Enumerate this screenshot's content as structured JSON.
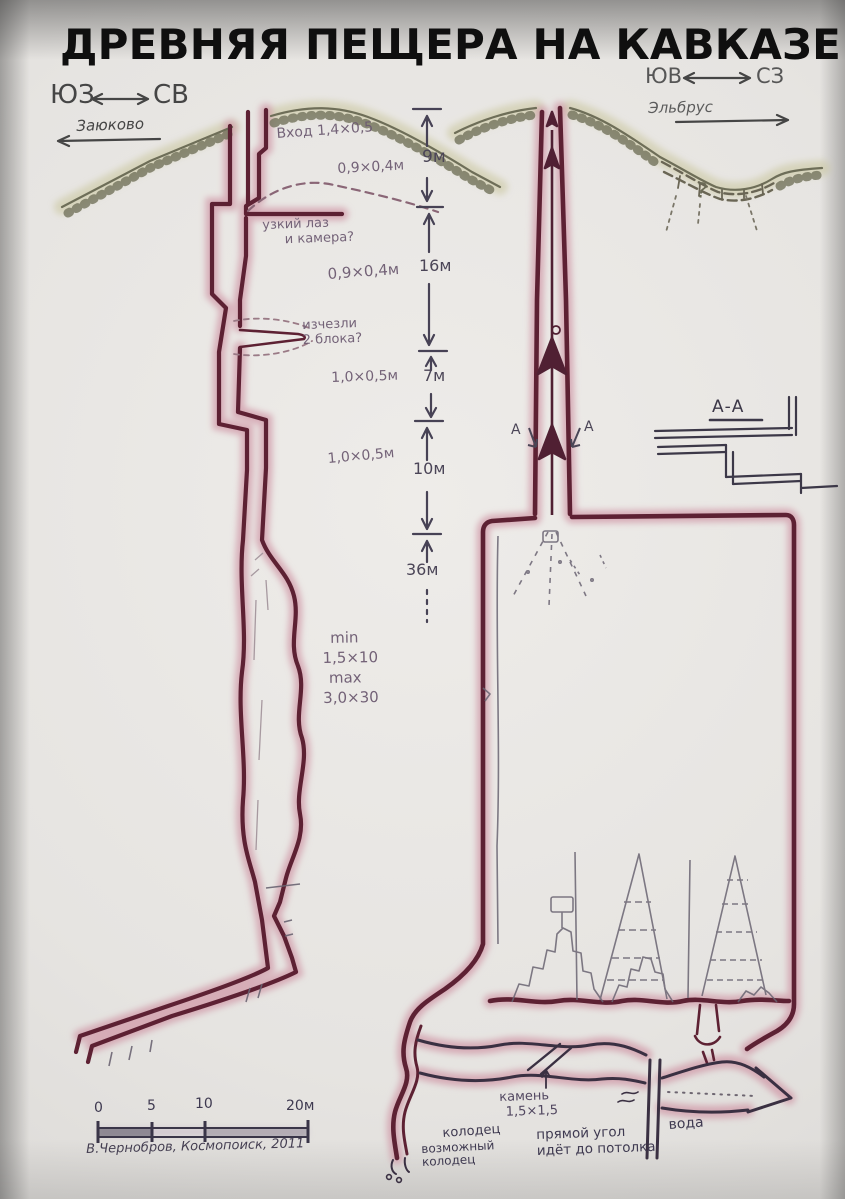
{
  "title": "ДРЕВНЯЯ ПЕЩЕРА НА КАВКАЗЕ",
  "compass_left": {
    "sw": "ЮЗ",
    "ne": "СВ",
    "place": "Заюково"
  },
  "compass_right": {
    "se": "ЮВ",
    "nw": "СЗ",
    "place": "Эльбрус"
  },
  "left_section": {
    "entrance": "Вход 1,4×0,5",
    "dim_upper": "0,9×0,4м",
    "narrow_note_1": "узкий лаз",
    "narrow_note_2": "и камера?",
    "dim_mid": "0,9×0,4м",
    "blocks_note_1": "изчезли",
    "blocks_note_2": "2 блока?",
    "dim_lower": "1,0×0,5м",
    "dim_lowest": "1,0×0,5м",
    "size_min_label": "min",
    "size_min_value": "1,5×10",
    "size_max_label": "max",
    "size_max_value": "3,0×30"
  },
  "depth_scale": {
    "seg1": "9м",
    "seg2": "16м",
    "seg3": "7м",
    "seg4": "10м",
    "seg5": "36м"
  },
  "section_cut": {
    "left_mark": "А",
    "right_mark": "А",
    "detail_title": "А-А"
  },
  "right_section": {
    "unknown_mark": "?"
  },
  "bottom_detail": {
    "stone_1": "камень",
    "stone_2": "1,5×1,5",
    "well": "колодец",
    "possible_well_1": "возможный",
    "possible_well_2": "колодец",
    "right_angle_1": "прямой угол",
    "right_angle_2": "идёт до потолка",
    "water": "вода"
  },
  "scale_bar": {
    "t0": "0",
    "t1": "5",
    "t2": "10",
    "t3": "20м"
  },
  "credit": "В.Чернобров, Космопоиск, 2011",
  "colors": {
    "wall": "#5d2133",
    "wall_halo": "#d09aa8",
    "ink": "#6d5b72",
    "pencil": "#6a6472",
    "terrain": "#c8c59b",
    "detail_ink": "#3c3848",
    "title": "#101010"
  }
}
